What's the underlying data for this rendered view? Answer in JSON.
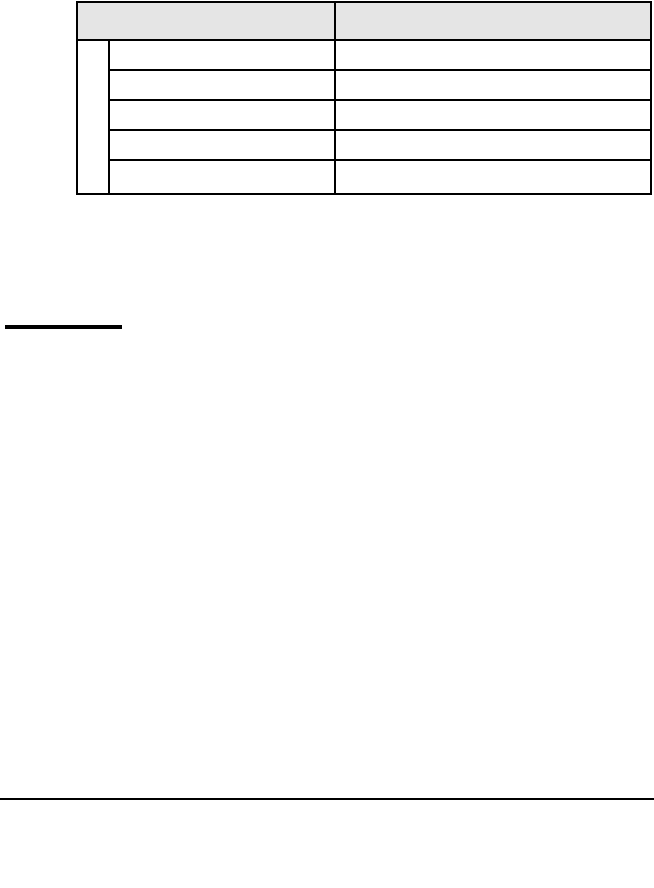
{
  "page": {
    "background_color": "#ffffff"
  },
  "table": {
    "border_color": "#000000",
    "header": {
      "background_color": "#e5e5e5",
      "cells": [
        {
          "label": ""
        },
        {
          "label": ""
        }
      ]
    },
    "side_column_cell": {
      "label": ""
    },
    "rows": [
      {
        "cells": [
          "",
          ""
        ]
      },
      {
        "cells": [
          "",
          ""
        ]
      },
      {
        "cells": [
          "",
          ""
        ]
      },
      {
        "cells": [
          "",
          ""
        ]
      },
      {
        "cells": [
          "",
          ""
        ]
      }
    ]
  },
  "rules": {
    "short_heavy_rule": {
      "color": "#000000"
    },
    "footer_rule": {
      "color": "#000000"
    }
  }
}
